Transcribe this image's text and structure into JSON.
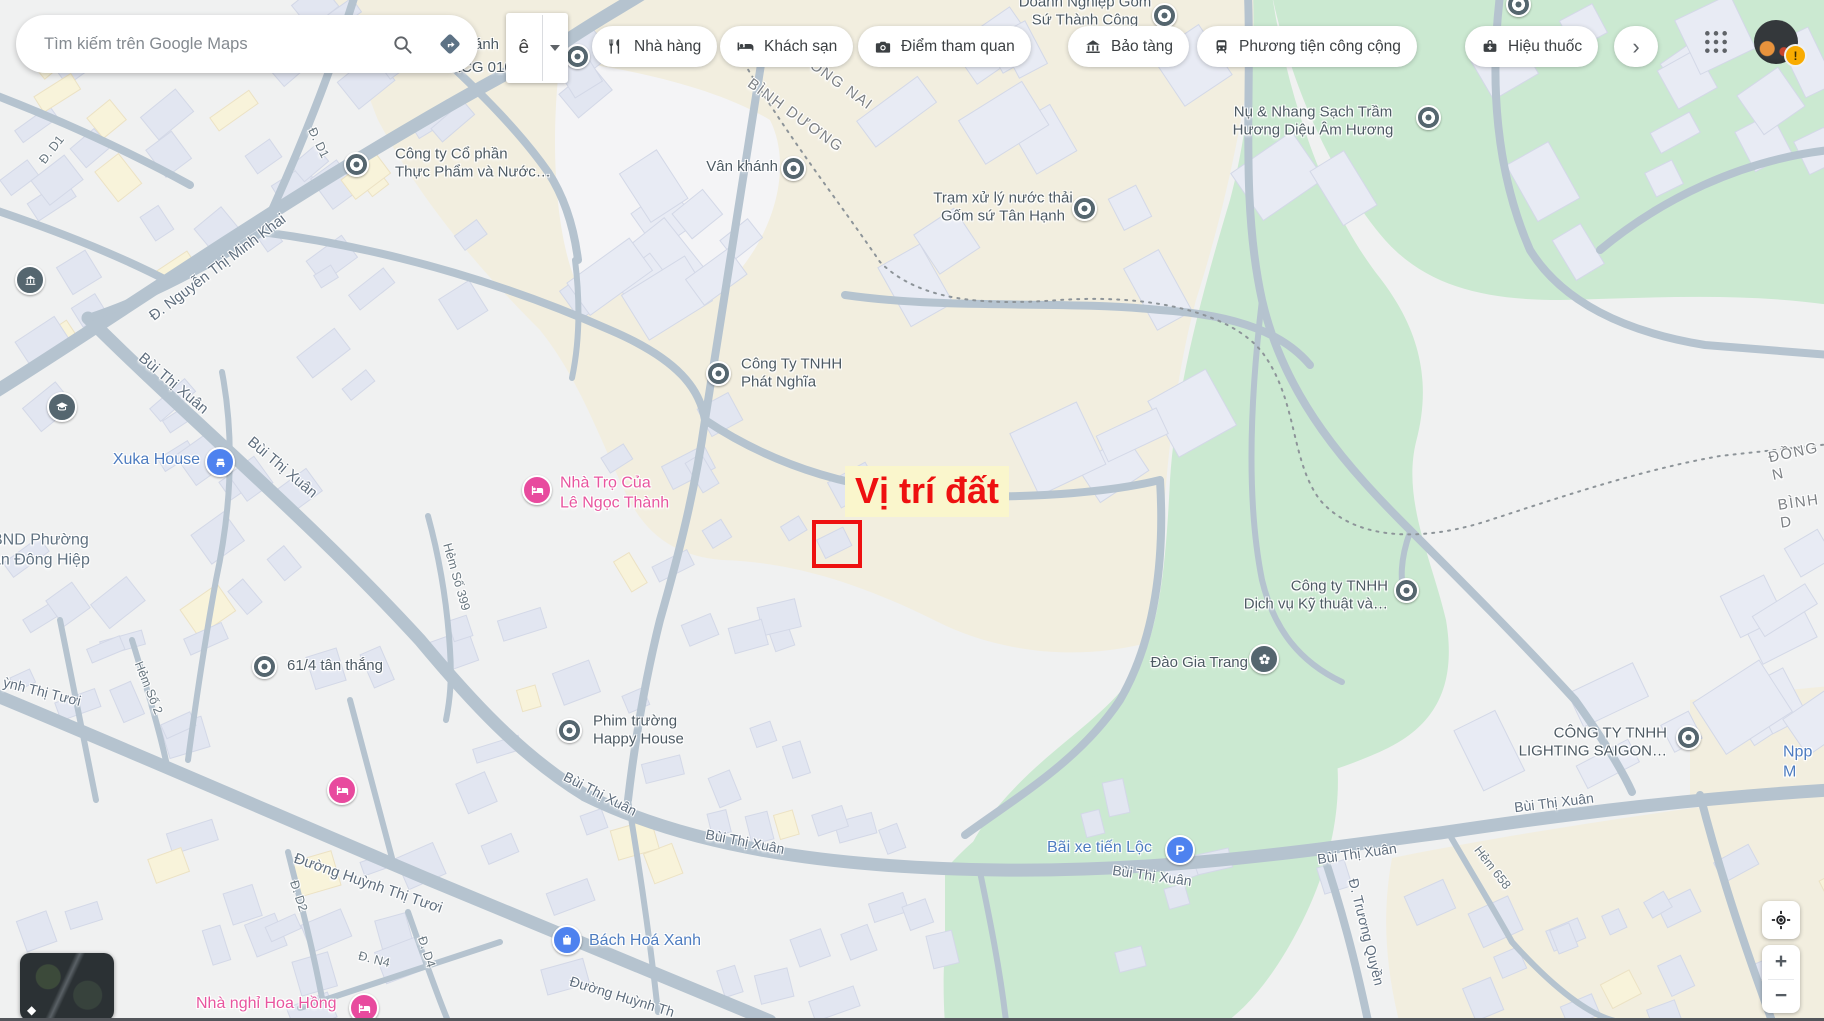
{
  "topbar": {
    "search_placeholder": "Tìm kiếm trên Google Maps",
    "ime_button": "ê",
    "chips": [
      {
        "icon": "restaurant-icon",
        "label": "Nhà hàng"
      },
      {
        "icon": "hotel-icon",
        "label": "Khách sạn"
      },
      {
        "icon": "camera-icon",
        "label": "Điểm tham quan"
      },
      {
        "icon": "museum-icon",
        "label": "Bảo tàng"
      },
      {
        "icon": "transit-icon",
        "label": "Phương tiện công cộng"
      },
      {
        "icon": "pharmacy-icon",
        "label": "Hiệu thuốc"
      }
    ],
    "more_chip": "›",
    "avatar_badge": "!"
  },
  "annotation": {
    "label": "Vị trí đất",
    "accent_color": "#ee1010"
  },
  "map": {
    "pois": [
      {
        "text": "Công ty Cổ phần\nThực Phẩm và Nước…"
      },
      {
        "text": "Vân khánh"
      },
      {
        "text": "Trạm xử lý nước thải\nGốm sứ Tân Hạnh"
      },
      {
        "text": "Nụ & Nhang Sạch Trầm\nHương Diệu Âm Hương"
      },
      {
        "text": "Công Ty TNHH\nPhát Nghĩa"
      },
      {
        "text": "Xuka House"
      },
      {
        "text": "Nhà Trọ Của\nLê Ngọc Thành"
      },
      {
        "text": "BND Phường\nan Đông Hiệp"
      },
      {
        "text": "61/4 tân thắng"
      },
      {
        "text": "Phim trường\nHappy House"
      },
      {
        "text": "Công ty TNHH\nDịch vụ Kỹ thuật và…"
      },
      {
        "text": "Đào Gia Trang"
      },
      {
        "text": "CÔNG TY TNHH\nLIGHTING SAIGON…"
      },
      {
        "text": "Npp M"
      },
      {
        "text": "Bãi xe tiến Lộc"
      },
      {
        "text": "Bách Hoá Xanh"
      },
      {
        "text": "Nhà nghỉ Hoa Hồng"
      },
      {
        "text": "Doanh Nghiệp Gốm\nSứ Thành Công"
      },
      {
        "text": "ánh"
      },
      {
        "text": "KCG 01020"
      }
    ],
    "streets": [
      {
        "text": "Đ. Nguyễn Thị Minh Khai"
      },
      {
        "text": "Đ. D1"
      },
      {
        "text": "Đ. D1"
      },
      {
        "text": "Bùi Thị Xuân"
      },
      {
        "text": "Bùi Thị Xuân"
      },
      {
        "text": "Hẻm Số 399"
      },
      {
        "text": "Hẻm Số 2"
      },
      {
        "text": "ỳnh Thị Tươi"
      },
      {
        "text": "Đường Huỳnh Thị Tươi"
      },
      {
        "text": "Đ. D2"
      },
      {
        "text": "Đ. N4"
      },
      {
        "text": "Đ. D4"
      },
      {
        "text": "Đường Huỳnh Th"
      },
      {
        "text": "Bùi Thị Xuân"
      },
      {
        "text": "Bùi Thị Xuân"
      },
      {
        "text": "Bùi Thị Xuân"
      },
      {
        "text": "Bùi Thị Xuân"
      },
      {
        "text": "Bùi Thị Xuân"
      },
      {
        "text": "Đ. Trương Quyền"
      },
      {
        "text": "Hẻm 658"
      }
    ],
    "boundaries": [
      {
        "text": "ĐỒNG NAI"
      },
      {
        "text": "BÌNH DƯƠNG"
      },
      {
        "text": "ĐỒNG N"
      },
      {
        "text": "BÌNH D"
      }
    ],
    "colors": {
      "park_green": "#cbe9d1",
      "industrial_beige": "#f2eedf",
      "road": "#b5c3cf"
    }
  },
  "controls": {
    "zoom_in": "+",
    "zoom_out": "−",
    "layers_icon": "◆"
  }
}
